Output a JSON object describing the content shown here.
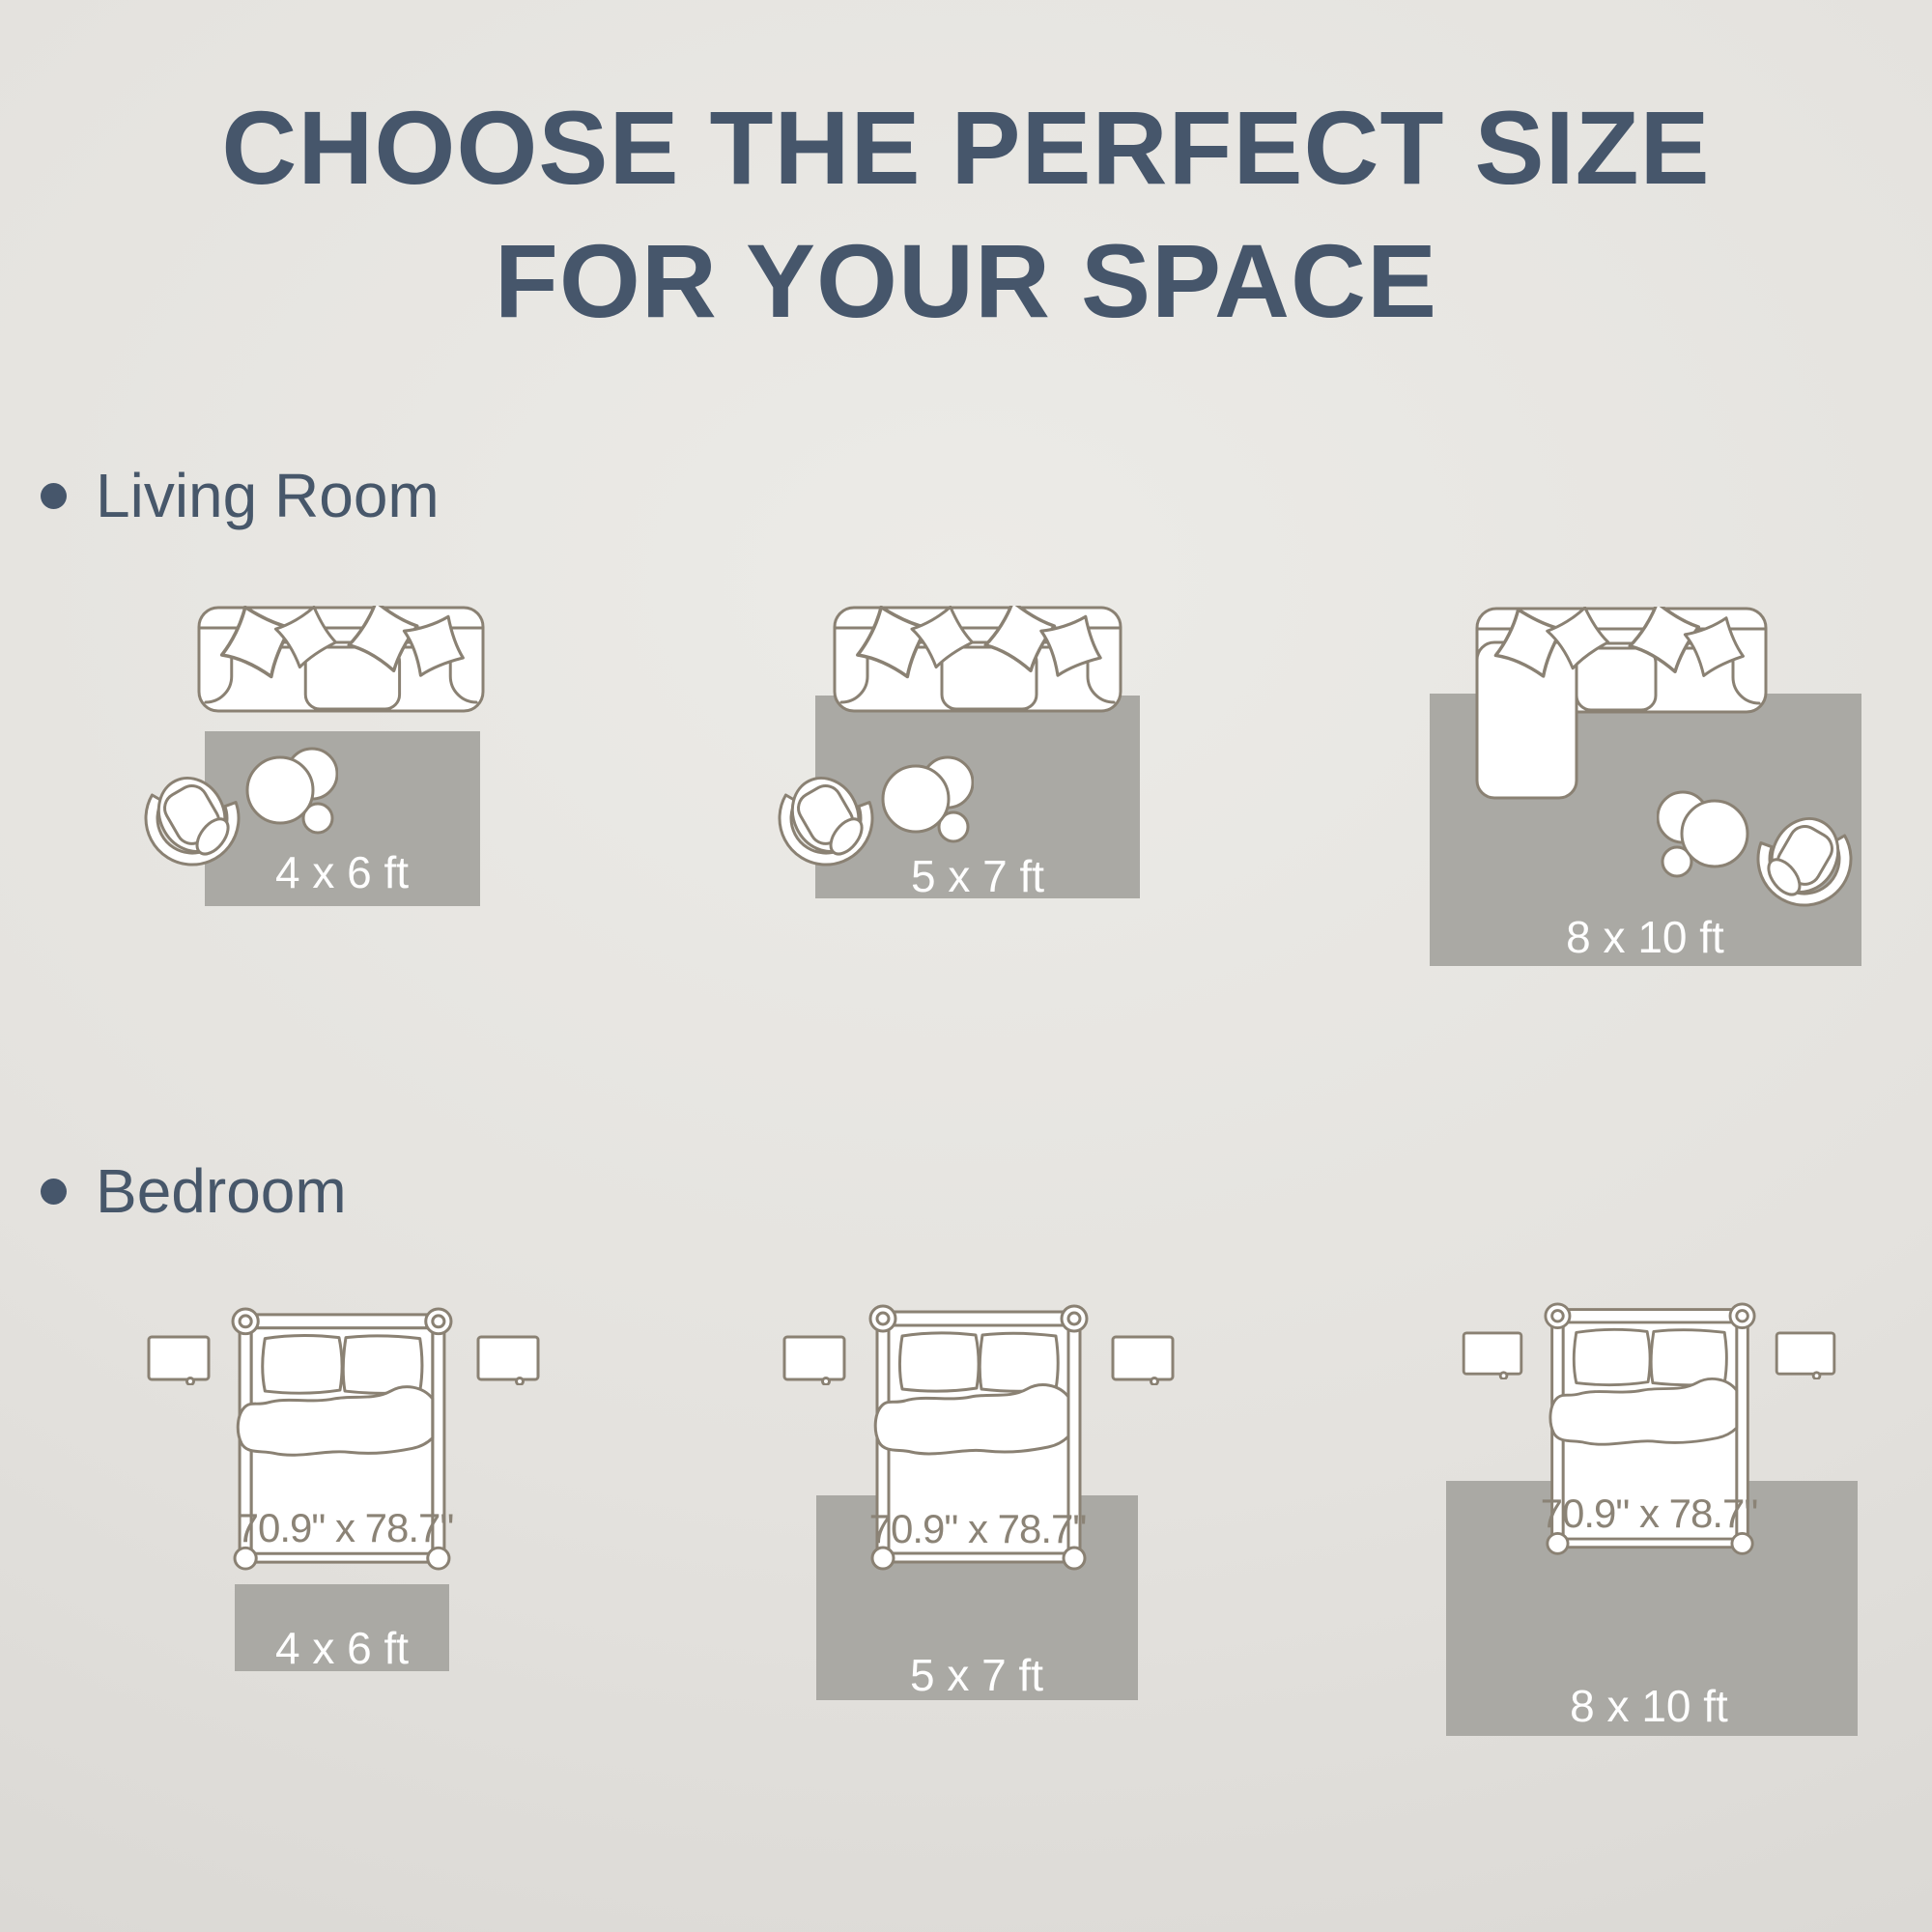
{
  "title": {
    "line1": "CHOOSE THE PERFECT SIZE",
    "line2": "FOR YOUR SPACE"
  },
  "living_room": {
    "label": "Living Room",
    "layouts": [
      {
        "rug_size": "4 x 6 ft"
      },
      {
        "rug_size": "5 x 7 ft"
      },
      {
        "rug_size": "8 x 10 ft"
      }
    ]
  },
  "bedroom": {
    "label": "Bedroom",
    "layouts": [
      {
        "bed_size": "70.9\" x 78.7\"",
        "rug_size": "4 x 6 ft"
      },
      {
        "bed_size": "70.9\" x 78.7\"",
        "rug_size": "5 x 7 ft"
      },
      {
        "bed_size": "70.9\" x 78.7\"",
        "rug_size": "8 x 10 ft"
      }
    ]
  },
  "colors": {
    "heading": "#46566b",
    "furniture_outline": "#8a8173",
    "rug_fill": "#aaa9a4",
    "rug_label": "#ffffff",
    "bed_size_label": "#8b8376"
  }
}
